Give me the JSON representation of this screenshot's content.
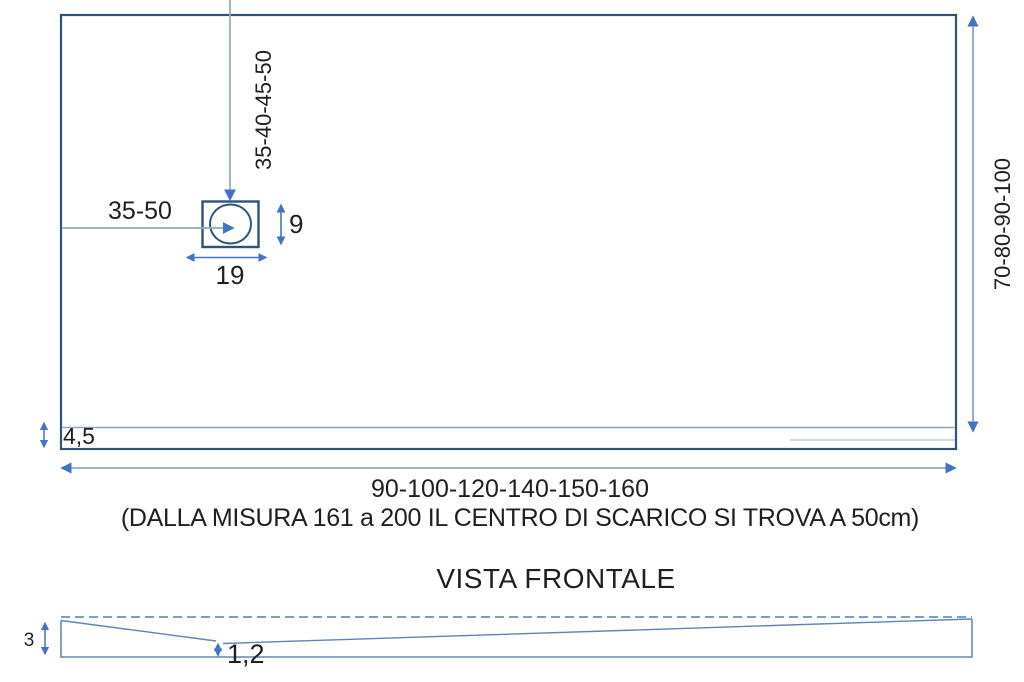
{
  "top_view": {
    "drain_vertical_offset_label": "35-40-45-50",
    "drain_horizontal_offset_label": "35-50",
    "drain_width_label": "19",
    "drain_height_label": "9",
    "tray_depth_label": "70-80-90-100",
    "border_thickness_label": "4,5",
    "tray_width_label": "90-100-120-140-150-160",
    "note": "(DALLA MISURA 161 a 200 IL CENTRO DI SCARICO SI TROVA A 50cm)"
  },
  "front_view": {
    "title": "VISTA FRONTALE",
    "edge_height_label": "3",
    "min_thickness_label": "1,2"
  },
  "colors": {
    "outline_dark_blue": "#2f5478",
    "dimension_light_blue": "#7f9cc4",
    "arrow_blue": "#4472c4",
    "front_outline_blue": "#5f85b5",
    "text": "#1f1f1f"
  }
}
